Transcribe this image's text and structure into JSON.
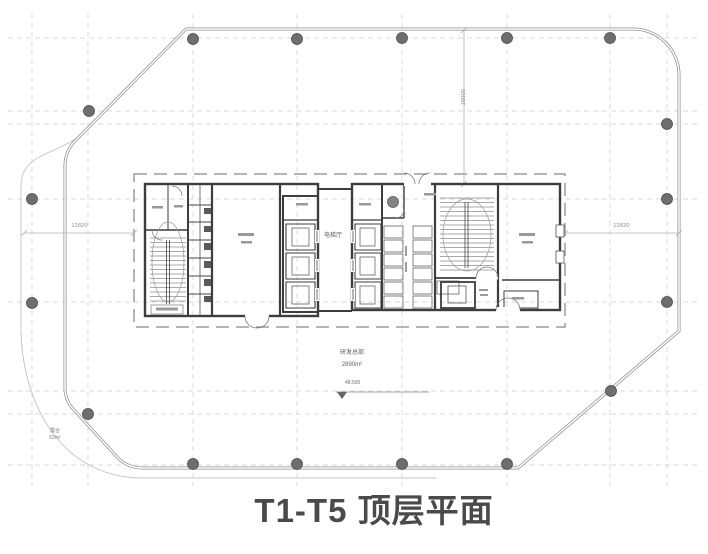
{
  "title": "T1-T5 顶层平面",
  "labels": {
    "elevator_hall": "电梯厅",
    "main_zone_name": "研发总部",
    "main_zone_area": "2890m²",
    "level_mark": "48.500",
    "terrace_name": "露台",
    "terrace_area": "62m²"
  },
  "dimensions": {
    "left": "12820",
    "right": "12820",
    "vertical": "16000"
  },
  "colors": {
    "envelope_wall": "#8f8f8f",
    "core_wall": "#3d3d3d",
    "grid_line": "#cdcdcd",
    "column_fill": "#6e6e6e",
    "title_text": "#4a4a4a"
  }
}
